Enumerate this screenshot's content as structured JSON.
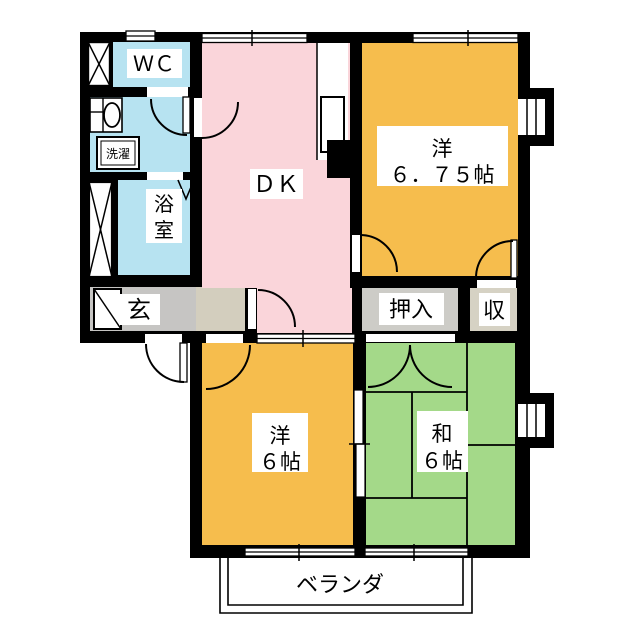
{
  "plan": {
    "labels": {
      "wc": "ＷＣ",
      "laundry": "洗濯",
      "bath_char1": "浴",
      "bath_char2": "室",
      "entrance": "玄",
      "dk": "ＤＫ",
      "western675_name": "洋",
      "western675_size": "６．７５帖",
      "oshiire": "押入",
      "storage": "収",
      "western6_name": "洋",
      "western6_size": "６帖",
      "japanese6_name": "和",
      "japanese6_size": "６帖",
      "veranda": "ベランダ"
    },
    "colors": {
      "wall": "#000000",
      "water_rooms": "#B7E3F1",
      "dk": "#FAD5DA",
      "western_room": "#F6BD4D",
      "japanese_room": "#A4D989",
      "entrance_floor": "#C6C5C3",
      "hall_floor": "#D3CEBE",
      "oshiire_floor": "#CDCCC7",
      "storage_floor": "#D6D2C4",
      "label_box": "#FFFFFF"
    }
  }
}
